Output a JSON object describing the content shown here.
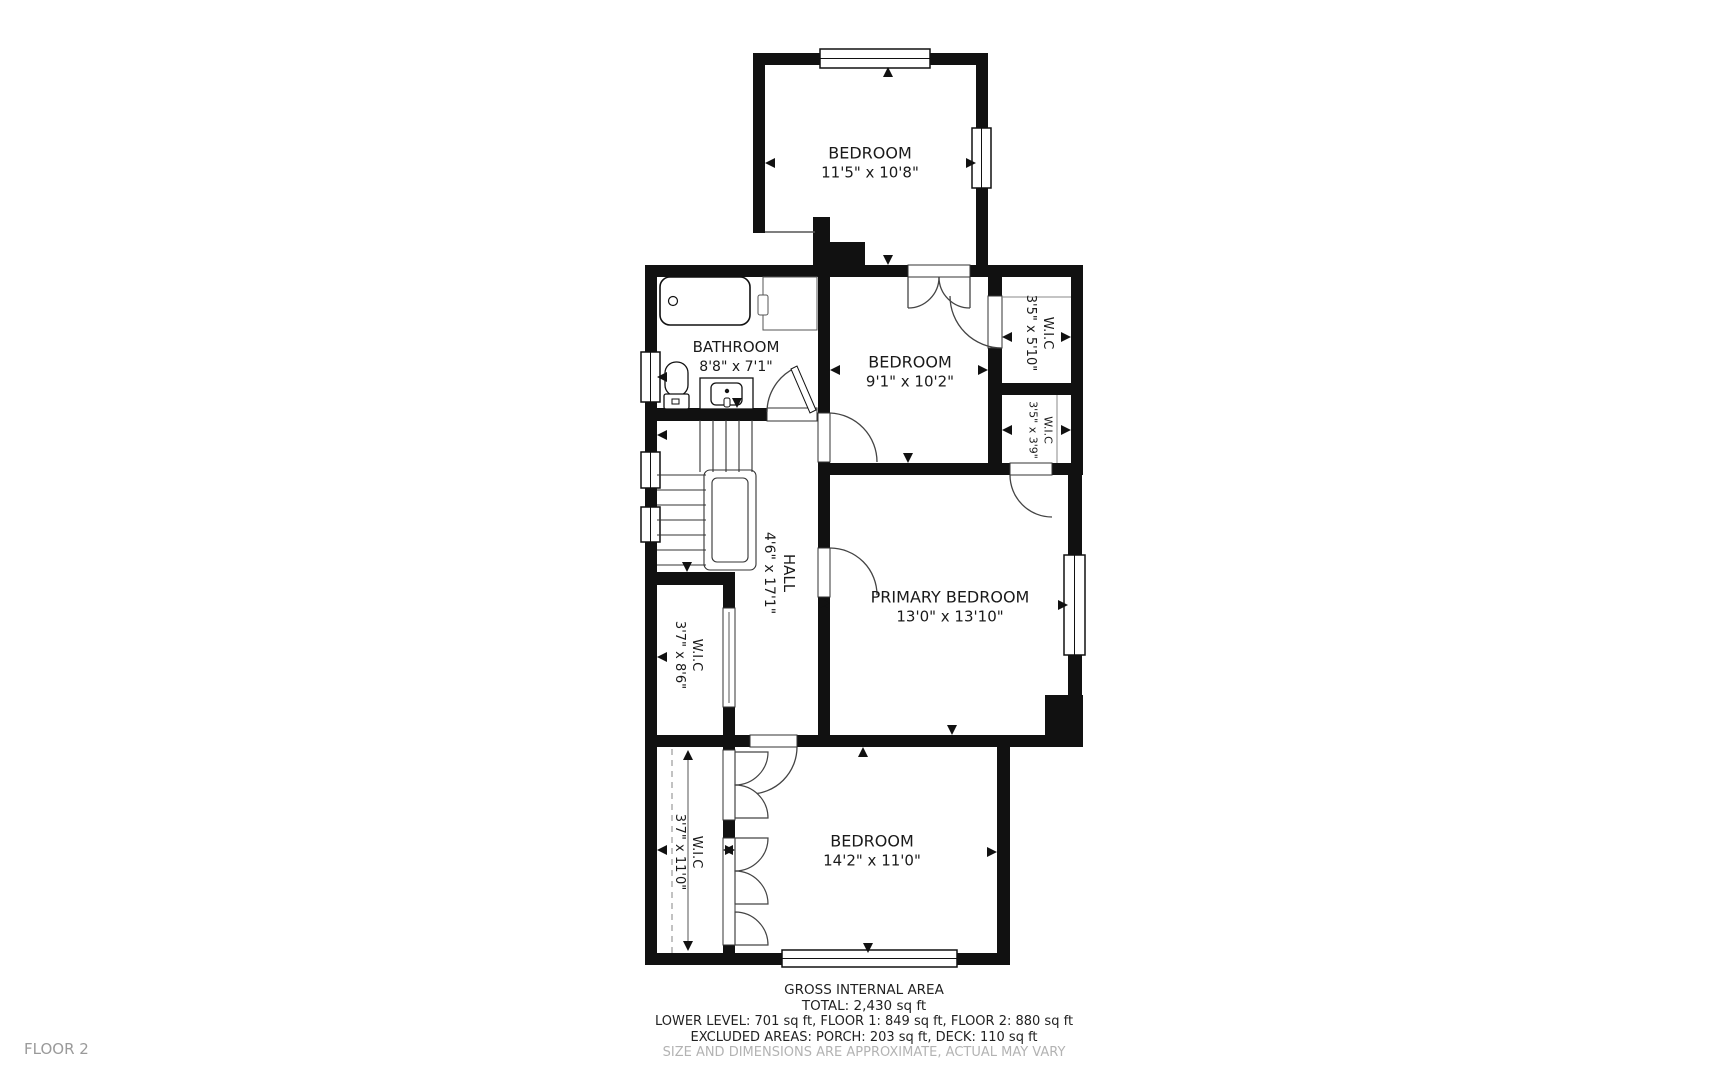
{
  "floor_label": "FLOOR 2",
  "rooms": [
    {
      "name": "BEDROOM",
      "dims": "11'5\" x 10'8\""
    },
    {
      "name": "BATHROOM",
      "dims": "8'8\" x 7'1\""
    },
    {
      "name": "BEDROOM",
      "dims": "9'1\" x 10'2\""
    },
    {
      "name": "W.I.C",
      "dims": "3'5\" x 5'10\""
    },
    {
      "name": "W.I.C",
      "dims": "3'5\" x 3'9\""
    },
    {
      "name": "HALL",
      "dims": "4'6\" x 17'1\""
    },
    {
      "name": "PRIMARY BEDROOM",
      "dims": "13'0\" x 13'10\""
    },
    {
      "name": "W.I.C",
      "dims": "3'7\" x 8'6\""
    },
    {
      "name": "W.I.C",
      "dims": "3'7\" x 11'0\""
    },
    {
      "name": "BEDROOM",
      "dims": "14'2\" x 11'0\""
    }
  ],
  "footer": {
    "title": "GROSS INTERNAL AREA",
    "total": "TOTAL: 2,430 sq ft",
    "levels": "LOWER LEVEL: 701 sq ft, FLOOR 1: 849 sq ft, FLOOR 2: 880 sq ft",
    "excluded": "EXCLUDED AREAS: PORCH: 203 sq ft, DECK: 110 sq ft",
    "disclaimer": "SIZE AND DIMENSIONS ARE APPROXIMATE, ACTUAL MAY VARY"
  },
  "colors": {
    "wall": "#111111",
    "text": "#1a1a1a",
    "muted": "#9a9a9a"
  }
}
